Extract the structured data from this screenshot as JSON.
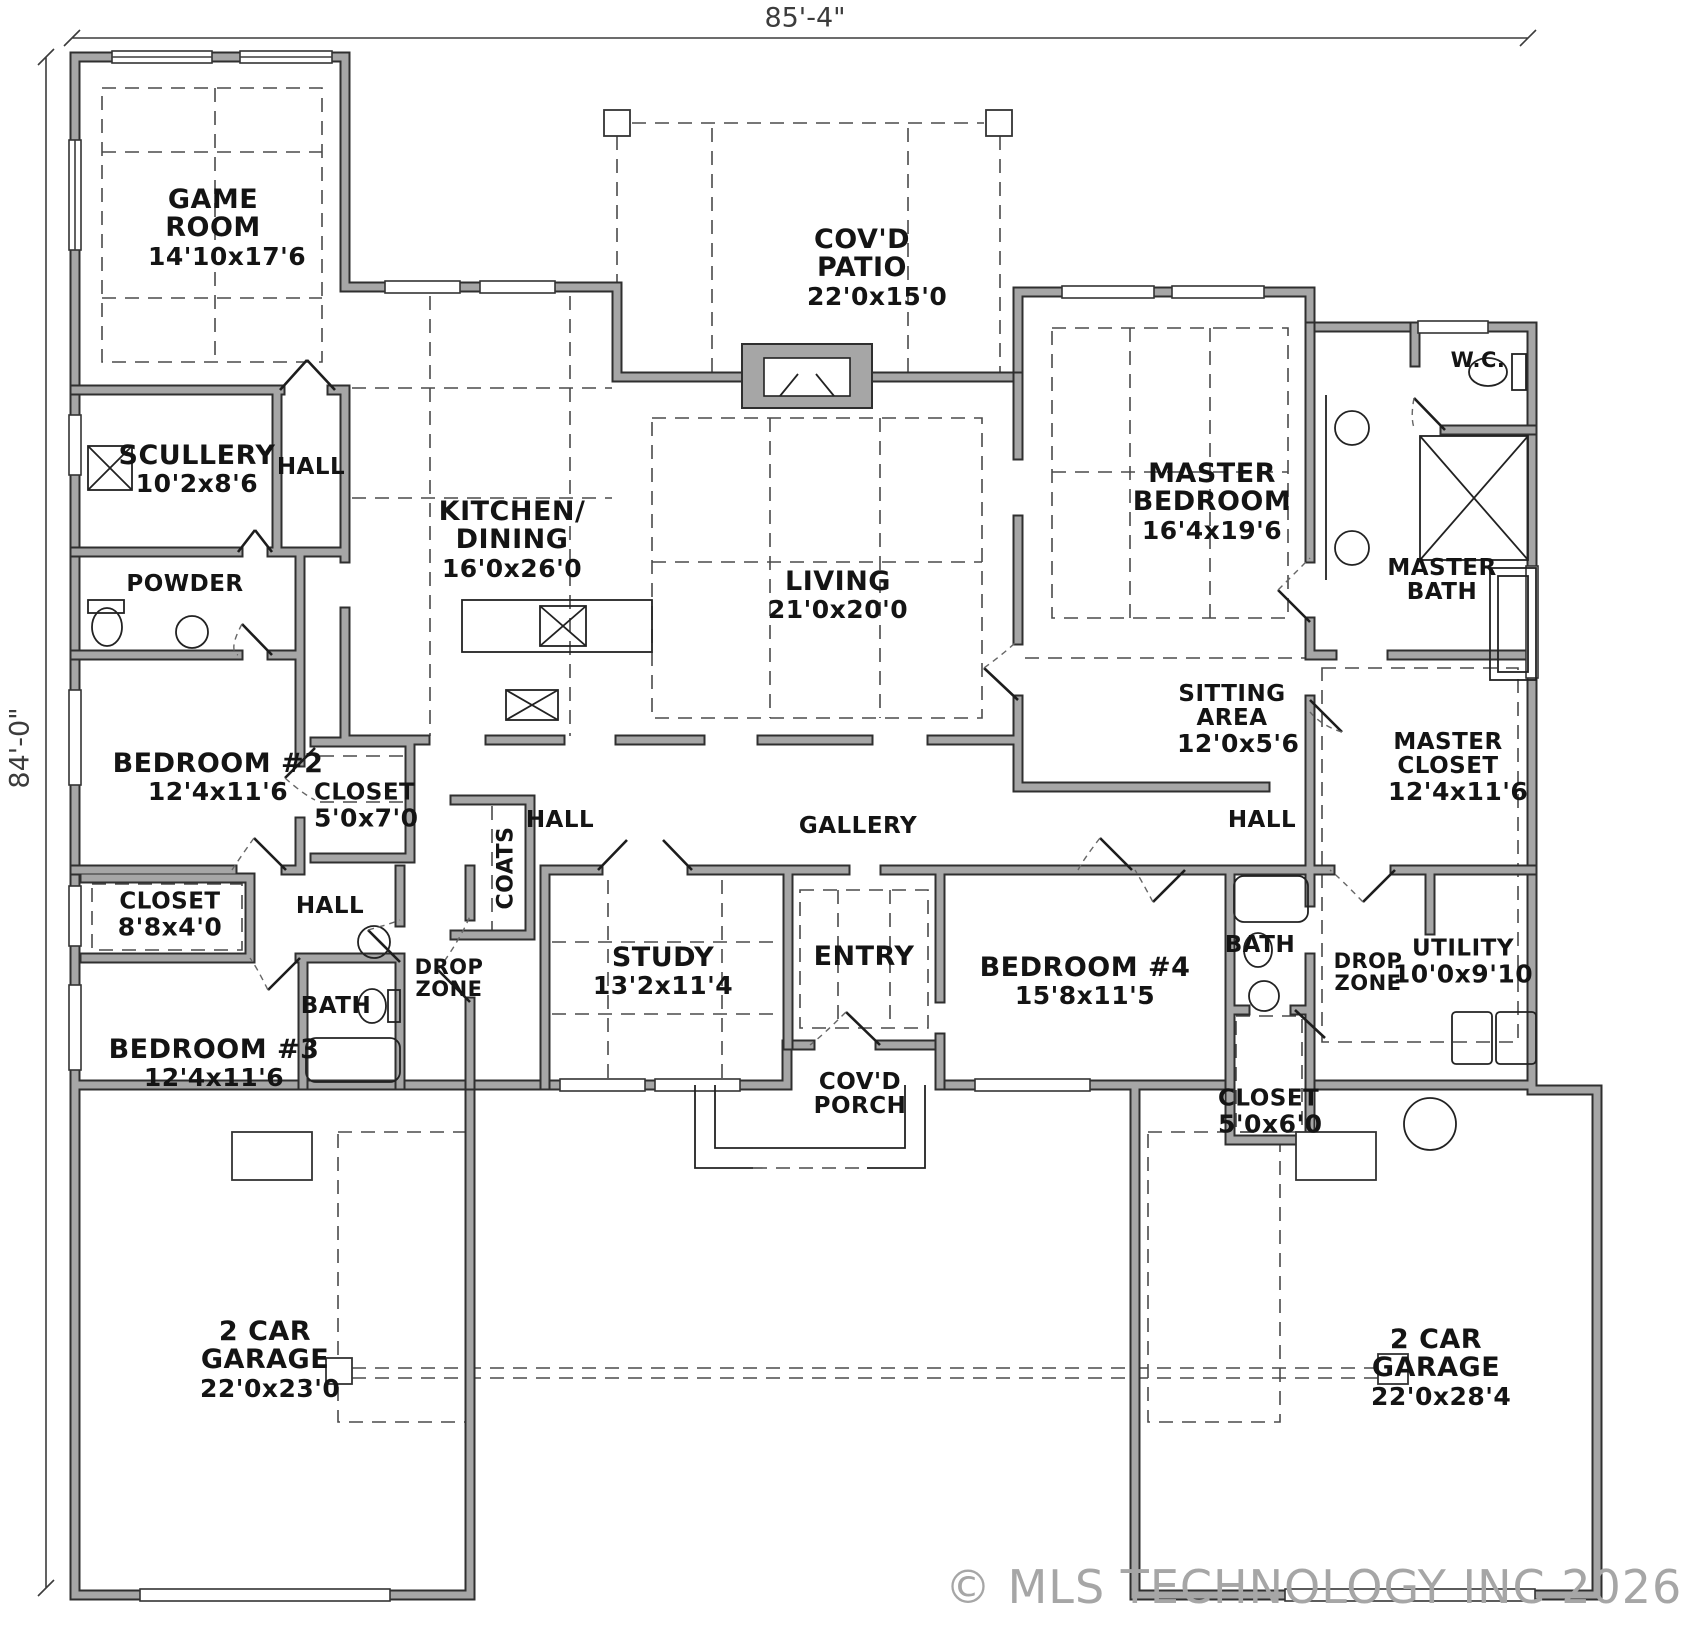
{
  "dimensions": {
    "top": "85'-4\"",
    "left": "84'-0\""
  },
  "watermark": "© MLS TECHNOLOGY INC 2026",
  "rooms": [
    {
      "id": "game-room",
      "name": "GAME ROOM",
      "dims": "14'10x17'6"
    },
    {
      "id": "scullery",
      "name": "SCULLERY",
      "dims": "10'2x8'6"
    },
    {
      "id": "hall-scullery",
      "name": "HALL"
    },
    {
      "id": "powder",
      "name": "POWDER"
    },
    {
      "id": "kitchen-dining",
      "name": "KITCHEN/ DINING",
      "dims": "16'0x26'0"
    },
    {
      "id": "covd-patio",
      "name": "COV'D PATIO",
      "dims": "22'0x15'0"
    },
    {
      "id": "living",
      "name": "LIVING",
      "dims": "21'0x20'0"
    },
    {
      "id": "master-bedroom",
      "name": "MASTER BEDROOM",
      "dims": "16'4x19'6"
    },
    {
      "id": "wc",
      "name": "W.C."
    },
    {
      "id": "master-bath",
      "name": "MASTER BATH"
    },
    {
      "id": "sitting-area",
      "name": "SITTING AREA",
      "dims": "12'0x5'6"
    },
    {
      "id": "master-closet",
      "name": "MASTER CLOSET",
      "dims": "12'4x11'6"
    },
    {
      "id": "bedroom-2",
      "name": "BEDROOM #2",
      "dims": "12'4x11'6"
    },
    {
      "id": "closet-bedroom2",
      "name": "CLOSET",
      "dims": "5'0x7'0"
    },
    {
      "id": "hall-center",
      "name": "HALL"
    },
    {
      "id": "gallery",
      "name": "GALLERY"
    },
    {
      "id": "hall-right",
      "name": "HALL"
    },
    {
      "id": "closet-hall",
      "name": "CLOSET",
      "dims": "8'8x4'0"
    },
    {
      "id": "hall-left",
      "name": "HALL"
    },
    {
      "id": "drop-zone-left",
      "name": "DROP ZONE"
    },
    {
      "id": "coats",
      "name": "COATS"
    },
    {
      "id": "study",
      "name": "STUDY",
      "dims": "13'2x11'4"
    },
    {
      "id": "entry",
      "name": "ENTRY"
    },
    {
      "id": "bedroom-4",
      "name": "BEDROOM #4",
      "dims": "15'8x11'5"
    },
    {
      "id": "bath-right",
      "name": "BATH"
    },
    {
      "id": "drop-zone-right",
      "name": "DROP ZONE"
    },
    {
      "id": "utility",
      "name": "UTILITY",
      "dims": "10'0x9'10"
    },
    {
      "id": "bedroom-3",
      "name": "BEDROOM #3",
      "dims": "12'4x11'6"
    },
    {
      "id": "bath-left",
      "name": "BATH"
    },
    {
      "id": "covd-porch",
      "name": "COV'D PORCH"
    },
    {
      "id": "closet-bedroom4",
      "name": "CLOSET",
      "dims": "5'0x6'0"
    },
    {
      "id": "garage-left",
      "name": "2 CAR GARAGE",
      "dims": "22'0x23'0"
    },
    {
      "id": "garage-right",
      "name": "2 CAR GARAGE",
      "dims": "22'0x28'4"
    }
  ]
}
